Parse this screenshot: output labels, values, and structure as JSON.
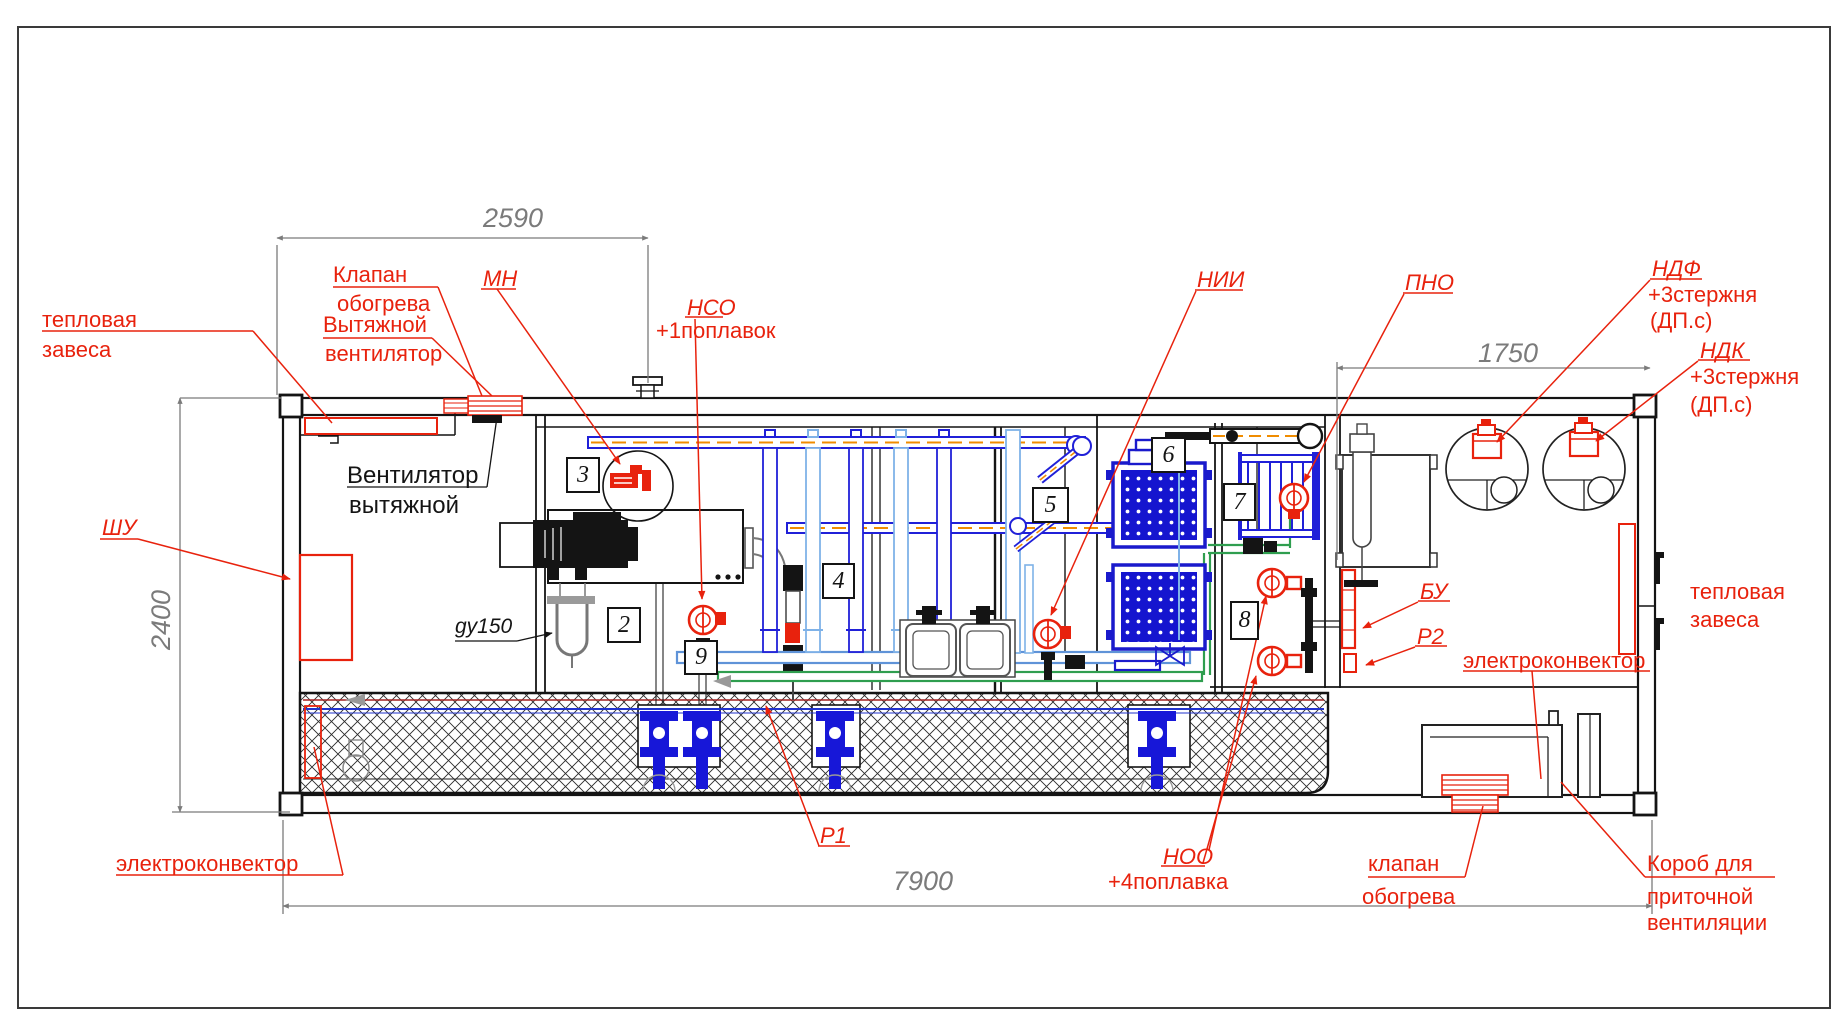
{
  "drawing_type": "containerized treatment-plant section view",
  "dimensions": {
    "top_left": "2590",
    "top_right": "1750",
    "height": "2400",
    "length": "7900"
  },
  "zones": {
    "z2": "2",
    "z3": "3",
    "z4": "4",
    "z5": "5",
    "z6": "6",
    "z7": "7",
    "z8": "8",
    "z9": "9"
  },
  "labels": {
    "thermal_curtain_left": {
      "line1": "тепловая",
      "line2": "завеса"
    },
    "heating_valve_top": {
      "line1": "Клапан",
      "line2": "обогрева"
    },
    "exhaust_fan_red": {
      "line1": "Вытяжной",
      "line2": "вентилятор"
    },
    "exhaust_fan_black": {
      "line1": "Вентилятор",
      "line2": "вытяжной"
    },
    "control_cabinet": "ШУ",
    "mn": "МН",
    "nso_tag": "НСО",
    "nso_note": "+1поплавок",
    "nii": "НИИ",
    "pno": "ПНО",
    "ndf_tag": "НДФ",
    "ndf_note1": "+3стержня",
    "ndf_note2": "(ДП.с)",
    "ndk_tag": "НДК",
    "ndk_note1": "+3стержня",
    "ndk_note2": "(ДП.с)",
    "bu": "БУ",
    "p2": "Р2",
    "p1": "Р1",
    "noo_tag": "НОО",
    "noo_note": "+4поплавка",
    "electroconvector_left": "электроконвектор",
    "electroconvector_right": "электроконвектор",
    "heating_valve_bottom": {
      "line1": "клапан",
      "line2": "обогрева"
    },
    "supply_duct": {
      "line1": "Короб для",
      "line2": "приточной",
      "line3": "вентиляции"
    },
    "thermal_curtain_right": {
      "line1": "тепловая",
      "line2": "завеса"
    },
    "gy150": "gy150"
  },
  "colors": {
    "label_red": "#e8220d",
    "line_black": "#141414",
    "dimension_gray": "#7b7b7b",
    "pipe_blue": "#2020d8",
    "pipe_light_blue": "#7fb2e8",
    "pipe_green": "#2f9e4f",
    "dash_orange": "#f08c00",
    "tank_blue": "#1515cf"
  }
}
